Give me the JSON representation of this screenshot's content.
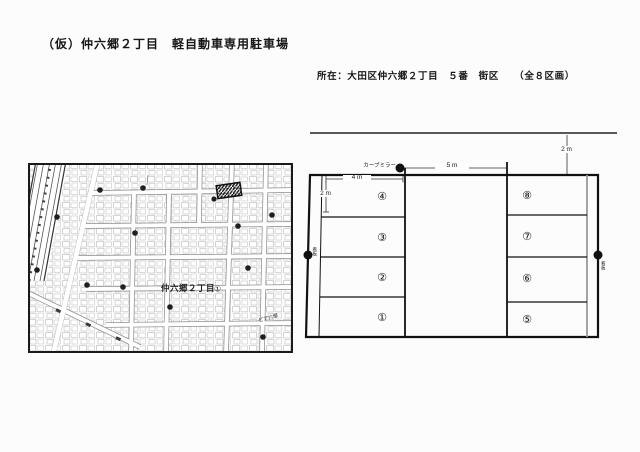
{
  "page": {
    "title": "（仮）仲六郷２丁目　軽自動車専用駐車場",
    "location_label": "所在：大田区仲六郷２丁目　５番　街区　　（全８区画）"
  },
  "map": {
    "district_label": "仲六郷２丁目",
    "district_marker": "①",
    "building_label": "ピア六郷"
  },
  "diagram": {
    "curve_mirror_label": "カーブミラー",
    "dim_road_offset": "2 m",
    "dim_aisle": "5 m",
    "dim_space_width": "4 m",
    "dim_space_depth": "2 m",
    "signboard_left": "看板",
    "signboard_right": "看板",
    "left_spaces": [
      "④",
      "③",
      "②",
      "①"
    ],
    "right_spaces": [
      "⑧",
      "⑦",
      "⑥",
      "⑤"
    ]
  }
}
